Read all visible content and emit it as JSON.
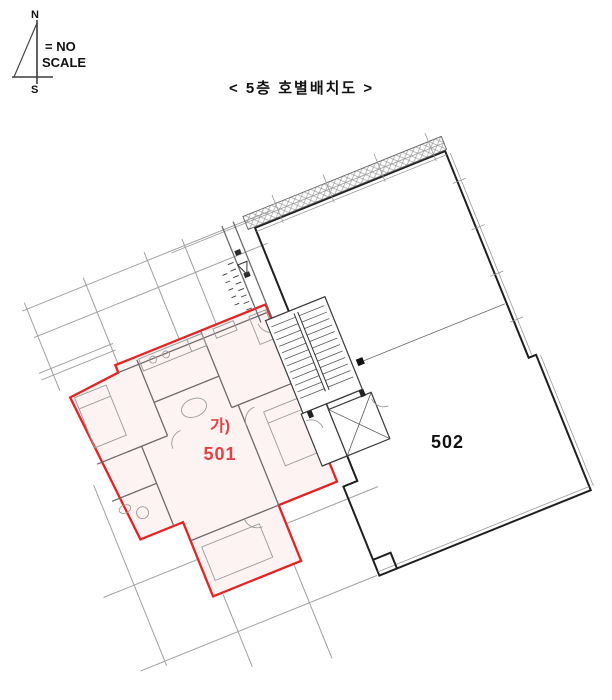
{
  "title": "< 5층 호별배치도  >",
  "compass": {
    "north": "N",
    "south": "S",
    "note_line1": "= NO",
    "note_line2": "SCALE"
  },
  "units": {
    "u501": {
      "group_tag": "가)",
      "number": "501"
    },
    "u502": {
      "number": "502"
    }
  },
  "colors": {
    "highlight_outline": "#e62222",
    "highlight_hatch": "#efadad",
    "highlight_label": "#e8403f",
    "wall_dark": "#1f1f1f",
    "wall_gray": "#6f6a6a",
    "grid_gray": "#a0a0a0",
    "text_black": "#111111"
  }
}
